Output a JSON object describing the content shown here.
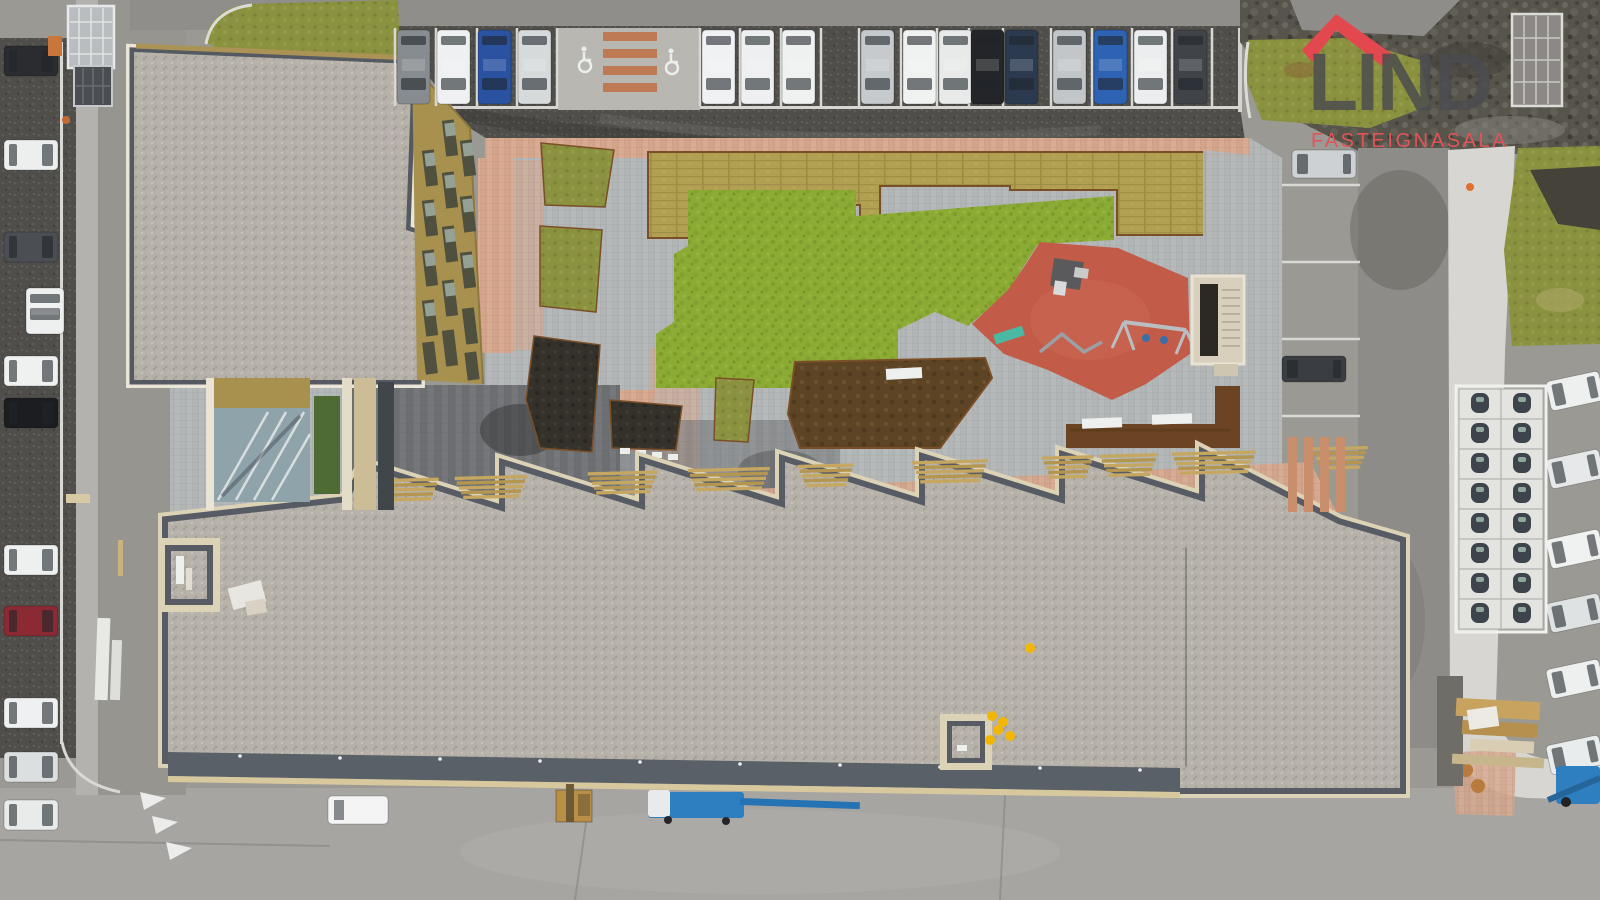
{
  "meta": {
    "description": "Aerial drone photo of an apartment complex with gravel roofs, landscaped courtyard, playground and parking lots"
  },
  "logo": {
    "name": "LIND",
    "subtitle": "FASTEIGNASALA",
    "roof_red": "#e2484d",
    "text_gray": "#4b4b4f",
    "subtitle_red": "#e15457"
  },
  "colors": {
    "road": "#9a9994",
    "road_bottom": "#a6a5a2",
    "road_right": "#8d8c88",
    "asphalt_dark": "#504e4a",
    "dirt": "#57544c",
    "gravel_roof": "#b6b2a9",
    "roof_border": "#575c64",
    "trim_white": "#eae5d7",
    "trim_beige": "#dcd2b6",
    "facade_gold": "#a8914f",
    "window_dark": "#50503f",
    "paving_gray": "#b6b9ba",
    "paving_pink": "#d9ab92",
    "lawn_green": "#8cab34",
    "turf_tan": "#b1a051",
    "grass_olive": "#8b923f",
    "soil_brown": "#5d4425",
    "soil_dark": "#34302a",
    "corten": "#7a4f27",
    "playground_red": "#c25b48",
    "stair_cream": "#d8cfbc",
    "sidewalk": "#d7d6d2",
    "carport_white": "#e3e3e0",
    "machine_blue": "#2e7fc0",
    "safety_yellow": "#f2b705",
    "bench_teal": "#4ab9a4",
    "line_white": "#d8d8d4"
  },
  "scene": {
    "cars": {
      "top_row": {
        "y": 30,
        "w": 33,
        "h": 74,
        "orient": "v",
        "items": [
          {
            "x": 397,
            "color": "#878c90"
          },
          {
            "x": 437,
            "color": "#eef0f1"
          },
          {
            "x": 478,
            "color": "#2a52a0"
          },
          {
            "x": 518,
            "color": "#d7dadb"
          },
          {
            "x": 702,
            "color": "#f0f1f2"
          },
          {
            "x": 741,
            "color": "#edeff0"
          },
          {
            "x": 782,
            "color": "#eff0f0"
          },
          {
            "x": 861,
            "color": "#c6cacc"
          },
          {
            "x": 903,
            "color": "#f0f1f1"
          },
          {
            "x": 939,
            "color": "#e8eaea"
          },
          {
            "x": 971,
            "color": "#232528"
          },
          {
            "x": 1005,
            "color": "#2c3a50"
          },
          {
            "x": 1053,
            "color": "#c2c6c9"
          },
          {
            "x": 1094,
            "color": "#2e62b2"
          },
          {
            "x": 1134,
            "color": "#ecedee"
          },
          {
            "x": 1174,
            "color": "#404449"
          }
        ]
      },
      "left_column": {
        "x": 4,
        "w": 54,
        "h": 30,
        "orient": "h",
        "items": [
          {
            "y": 46,
            "color": "#2b2c2f"
          },
          {
            "y": 140,
            "color": "#edefef"
          },
          {
            "y": 232,
            "color": "#4b4e52"
          },
          {
            "y": 356,
            "color": "#eff0f0"
          },
          {
            "y": 398,
            "color": "#1c1d20"
          },
          {
            "y": 545,
            "color": "#eef0f0"
          },
          {
            "y": 606,
            "color": "#8c2a33"
          },
          {
            "y": 698,
            "color": "#eff0f1"
          },
          {
            "y": 752,
            "color": "#dcdfe0"
          },
          {
            "y": 800,
            "color": "#e9ebeb"
          }
        ]
      },
      "van_left_vertical": {
        "x": 26,
        "y": 288,
        "w": 38,
        "h": 46,
        "color": "#eef0f0"
      },
      "right_column": {
        "x": 1548,
        "w": 54,
        "h": 30,
        "orient": "hl",
        "rotate": -12,
        "items": [
          {
            "y": 376,
            "color": "#eef0f0"
          },
          {
            "y": 454,
            "color": "#e6e8e9"
          },
          {
            "y": 534,
            "color": "#f0f1f1"
          },
          {
            "y": 598,
            "color": "#dfe2e3"
          },
          {
            "y": 664,
            "color": "#eef0f0"
          },
          {
            "y": 740,
            "color": "#e9ecec"
          }
        ]
      },
      "center": [
        {
          "x": 1292,
          "y": 150,
          "w": 64,
          "h": 28,
          "orient": "hl",
          "color": "#cdd1d3"
        },
        {
          "x": 1282,
          "y": 356,
          "w": 64,
          "h": 26,
          "orient": "hl",
          "color": "#3a3e42"
        }
      ]
    },
    "parking": {
      "top_lines": {
        "y1": 28,
        "y2": 106,
        "xs": [
          395,
          436,
          477,
          517,
          557,
          700,
          740,
          781,
          821,
          859,
          901,
          937,
          969,
          1003,
          1051,
          1092,
          1132,
          1172,
          1212
        ]
      },
      "right_lines": {
        "x1": 1282,
        "x2": 1360,
        "ys": [
          185,
          262,
          339,
          416
        ]
      },
      "accessible_icons": [
        {
          "x": 585,
          "y": 60
        },
        {
          "x": 672,
          "y": 62
        }
      ],
      "brick_stripes": {
        "x": 603,
        "w": 54,
        "h": 9,
        "ys": [
          32,
          49,
          66,
          83
        ]
      },
      "crosswalk_stripes": {
        "y": 437,
        "h": 75,
        "w": 9,
        "xs": [
          1288,
          1304,
          1320,
          1336
        ]
      }
    },
    "bench_stairs": [
      {
        "x": 383,
        "w": 56
      },
      {
        "x": 455,
        "w": 72
      },
      {
        "x": 588,
        "w": 70
      },
      {
        "x": 688,
        "w": 82
      },
      {
        "x": 798,
        "w": 56
      },
      {
        "x": 912,
        "w": 76
      },
      {
        "x": 1042,
        "w": 52
      },
      {
        "x": 1100,
        "w": 58
      },
      {
        "x": 1172,
        "w": 84
      },
      {
        "x": 1312,
        "w": 56
      }
    ],
    "carports": {
      "x": 1459,
      "y": 389,
      "cols": 2,
      "rows": 8,
      "cell_w": 42,
      "cell_h": 30
    },
    "flags": [
      [
        140,
        792
      ],
      [
        152,
        816
      ],
      [
        166,
        842
      ]
    ],
    "yellow_objects": [
      [
        1030,
        648
      ],
      [
        992,
        716
      ],
      [
        1003,
        722
      ],
      [
        998,
        730
      ],
      [
        1010,
        736
      ],
      [
        990,
        740
      ]
    ]
  }
}
